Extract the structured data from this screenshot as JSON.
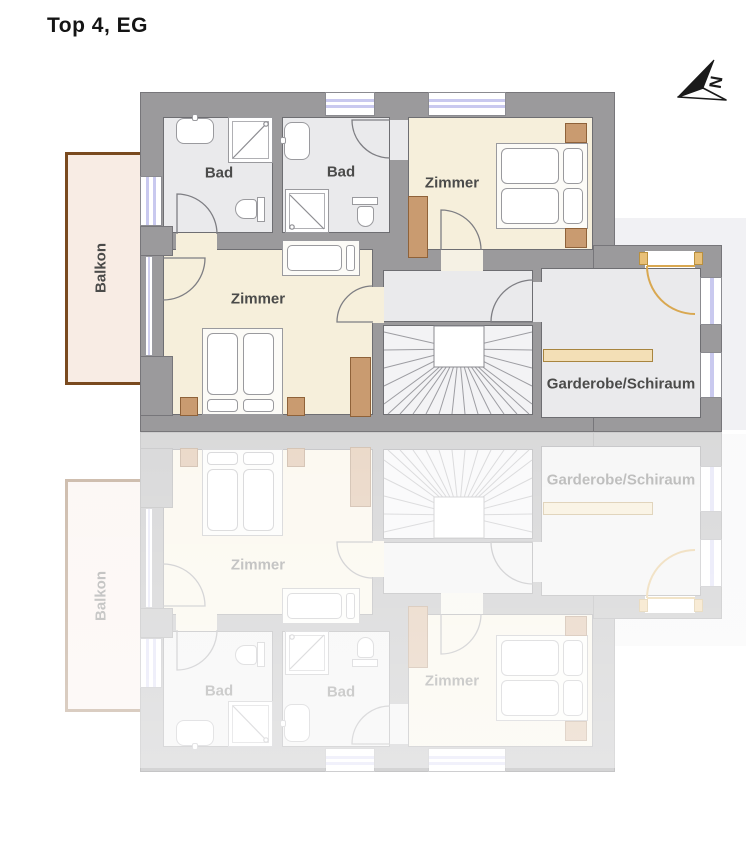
{
  "title": "Top 4, EG",
  "compass": {
    "label": "N"
  },
  "rooms": {
    "balkon": {
      "label": "Balkon"
    },
    "bad_left": {
      "label": "Bad"
    },
    "bad_right": {
      "label": "Bad"
    },
    "zimmer_top": {
      "label": "Zimmer"
    },
    "zimmer_main": {
      "label": "Zimmer"
    },
    "garderobe": {
      "label": "Garderobe/Schiraum"
    }
  },
  "colors": {
    "wall": "#9b9a9c",
    "room_floor_gray": "#eaeaec",
    "room_floor_beige": "#f6efdb",
    "stair_floor": "#f3f3f5",
    "balcony_floor": "#f8ece4",
    "balcony_railing": "#7a4a1f",
    "furniture_brown": "#c99b70",
    "wardrobe_bar": "#f3dfb6",
    "entrance_door": "#d9a851",
    "window_glass": "#c9c9ef",
    "label_text": "#4b4b4a"
  }
}
